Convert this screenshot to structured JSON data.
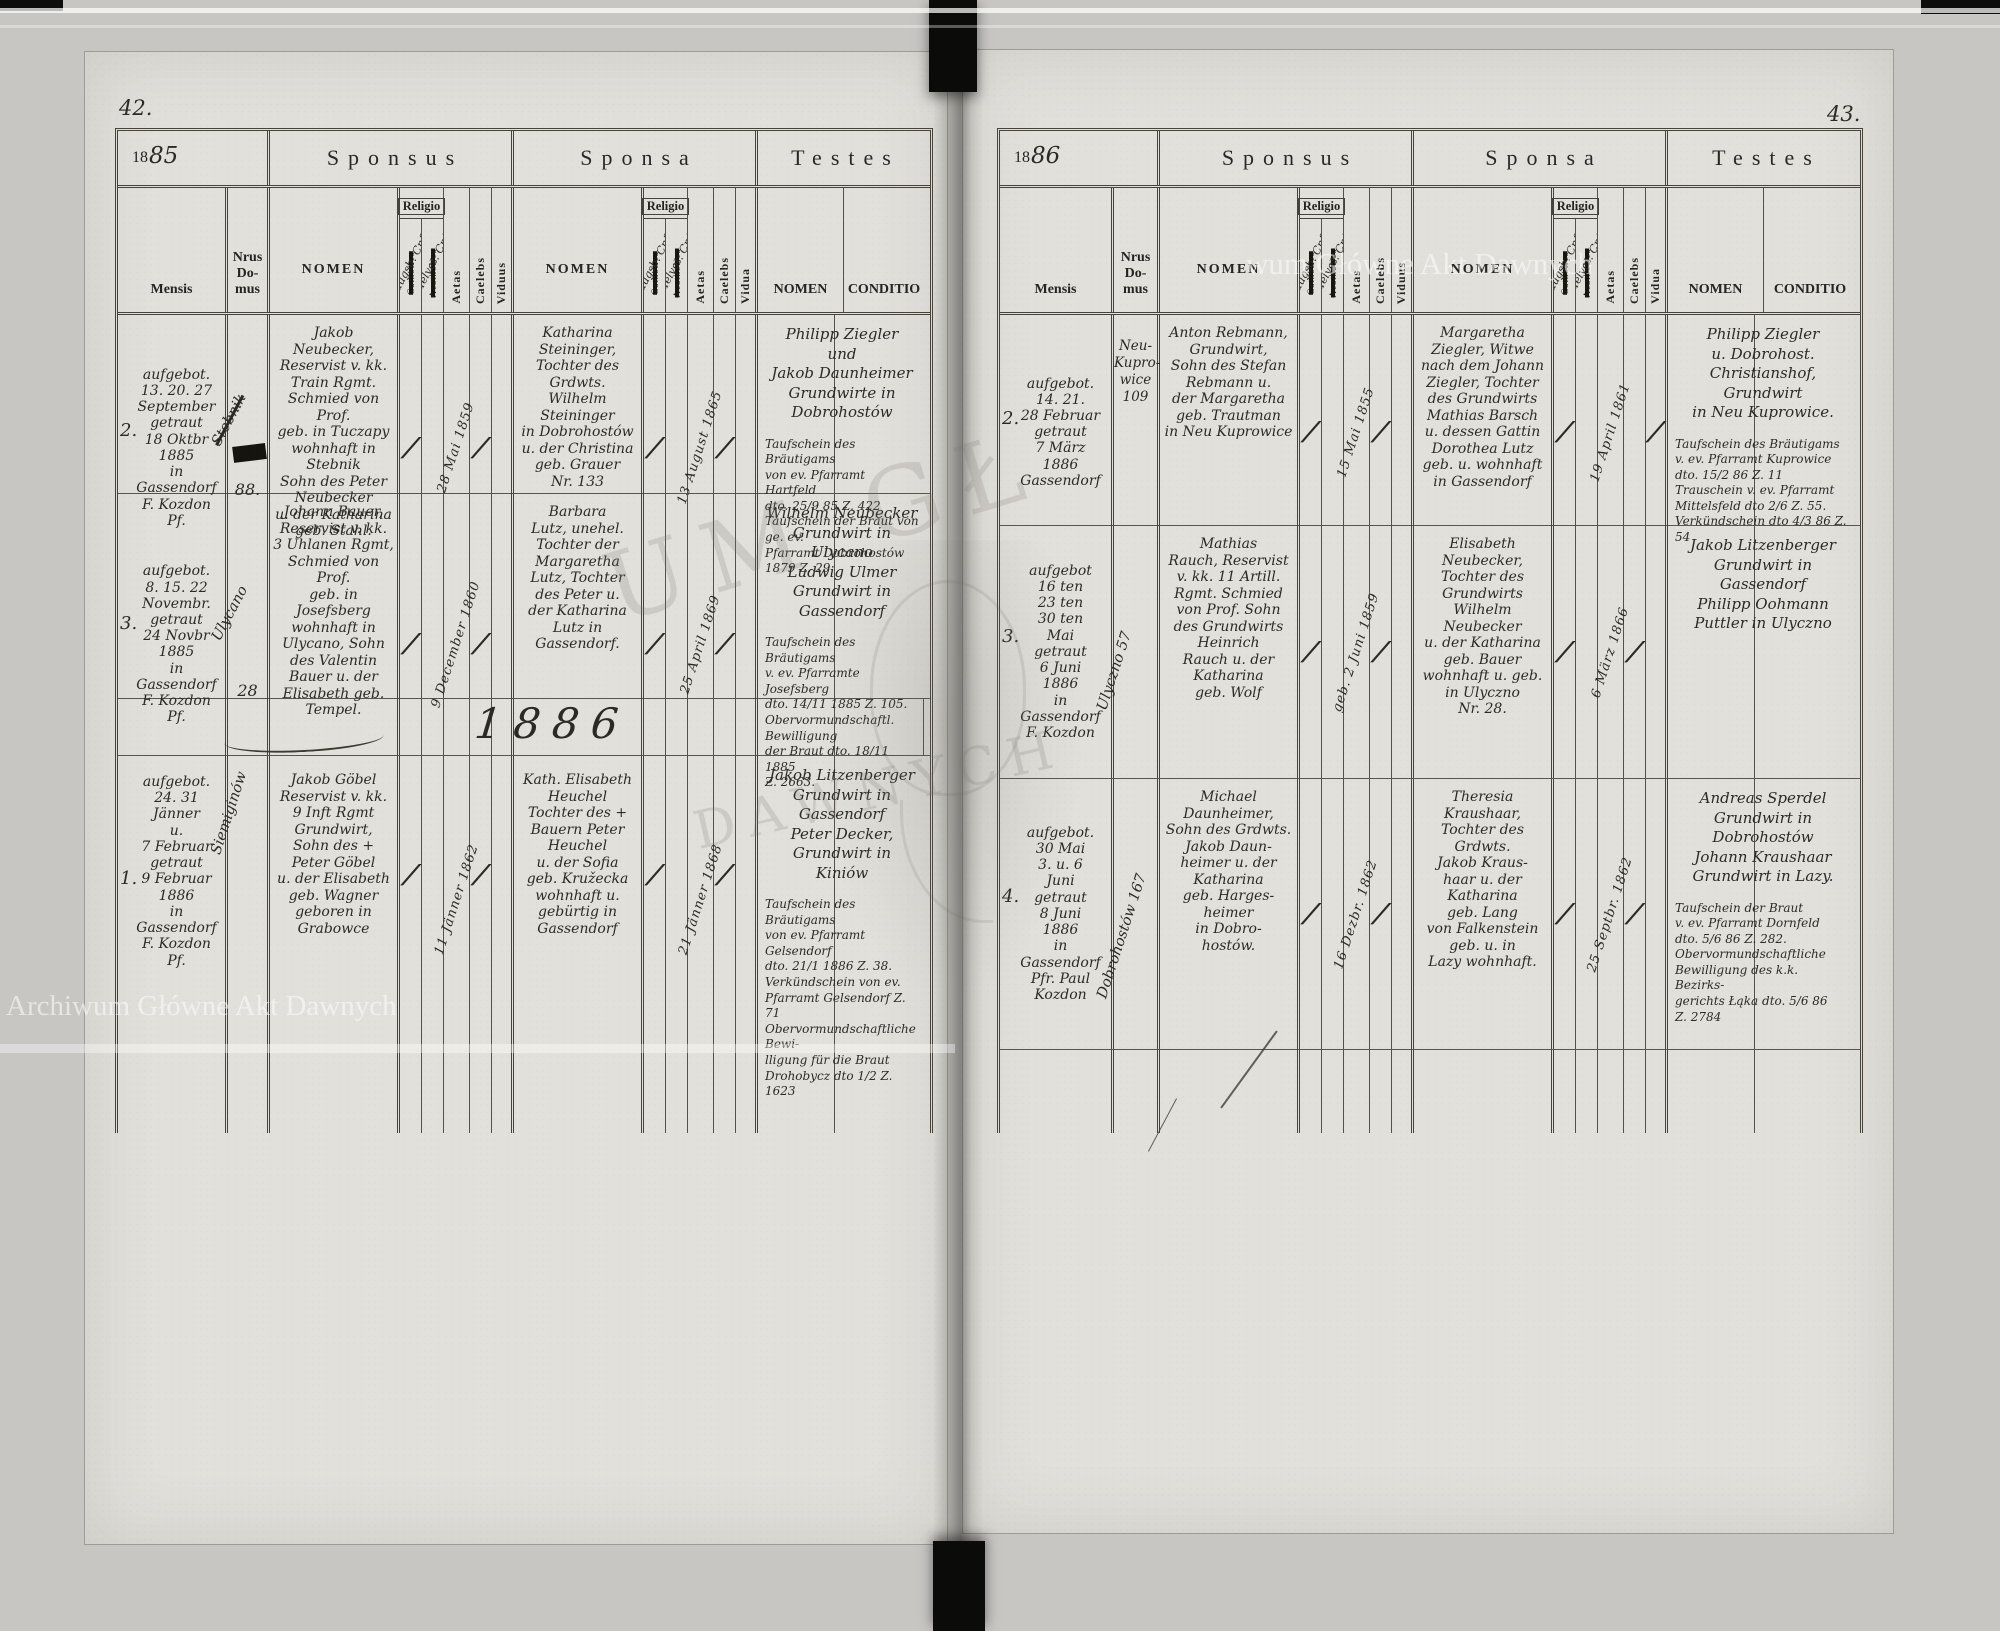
{
  "watermark": {
    "full": "Archiwum Główne Akt Dawnych",
    "top_right_partial": "wum Główne Akt Dawnych",
    "center_fragment_1": "UM GŁ",
    "center_fragment_2": "DAWNYCH"
  },
  "labels": {
    "sponsus": "Sponsus",
    "sponsa": "Sponsa",
    "testes": "Testes",
    "mensis": "Mensis",
    "nrus": "Nrus\nDo-\nmus",
    "nomen": "NOMEN",
    "religio": "Religio",
    "religio_catholica": "Catholica",
    "religio_acatholica": "Acatholica",
    "religio_augsb": "augsb. Cnf.",
    "religio_helv": "Helvet. Cnf.",
    "aetas": "Aetas",
    "caelebs": "Caelebs",
    "viduus": "Viduus",
    "vidua": "Vidua",
    "conditio": "CONDITIO"
  },
  "pages": [
    {
      "page_number": "42.",
      "year_printed": "18",
      "year_hand": "85",
      "year_band": "1886",
      "entries": [
        {
          "no": "2.",
          "mensis": "aufgebot.\n13. 20. 27\nSeptember\ngetraut\n18 Oktbr\n1885\nin\nGassendorf\nF. Kozdon\nPf.",
          "nrus_diag": "Stebnik",
          "nrus_struck": "111",
          "nrus": "88.",
          "sponsus_nomen": "Jakob Neubecker,\nReservist v. kk.\nTrain Rgmt.\nSchmied von Prof.\ngeb. in Tuczapy\nwohnhaft in Stebnik\nSohn des Peter\nNeubecker\nu. der Katharina\ngeb. Stahl.",
          "sp_rel": "/",
          "sp_aetas": "28 Mai 1859",
          "sp_caelebs": "/",
          "sp_viduus": "",
          "sponsa_nomen": "Katharina\nSteininger,\nTochter des Grdwts.\nWilhelm\nSteininger\nin Dobrohostów\nu. der Christina\ngeb. Grauer\nNr. 133",
          "spa_rel": "/",
          "spa_aetas": "13 August 1865",
          "spa_caelebs": "/",
          "spa_vidua": "",
          "testes_nomen": "Philipp Ziegler\nund\nJakob Daunheimer\nGrundwirte in Dobrohostów",
          "testes_notes": "Taufschein des Bräutigams\nvon ev. Pfarramt Hartfeld\ndto. 25/9 85 Z. 422\nTaufschein der Braut von ge. ev.\nPfarramt Dobrohostów 1879 Z. 29"
        },
        {
          "no": "3.",
          "mensis": "aufgebot.\n8. 15. 22\nNovembr.\ngetraut\n24 Novbr\n1885\nin\nGassendorf\nF. Kozdon\nPf.",
          "nrus_diag": "Ulycano",
          "nrus_struck": "",
          "nrus": "28",
          "sponsus_nomen": "Johann Bauer,\nReservist v. kk.\n3 Uhlanen Rgmt,\nSchmied von Prof.\ngeb. in Josefsberg\nwohnhaft in\nUlycano, Sohn\ndes Valentin\nBauer u. der\nElisabeth geb.\nTempel.",
          "sp_rel": "/",
          "sp_aetas": "9 December 1860",
          "sp_caelebs": "/",
          "sp_viduus": "",
          "sponsa_nomen": "Barbara\nLutz, unehel.\nTochter der\nMargaretha\nLutz, Tochter\ndes Peter u.\nder Katharina\nLutz in\nGassendorf.",
          "spa_rel": "/",
          "spa_aetas": "25 April 1869",
          "spa_caelebs": "/",
          "spa_vidua": "",
          "testes_nomen": "Wilhelm Neubecker\nGrundwirt in Ulycano\nLudwig Ulmer\nGrundwirt in Gassendorf",
          "testes_notes": "Taufschein des Bräutigams\nv. ev. Pfarramte Josefsberg\ndto. 14/11 1885 Z. 105.\nObervormundschaftl. Bewilligung\nder Braut dto. 18/11 1885\nZ. 2663."
        },
        {
          "no": "1.",
          "mensis": "aufgebot.\n24. 31\nJänner\nu.\n7 Februar\ngetraut\n9 Februar\n1886\nin\nGassendorf\nF. Kozdon\nPf.",
          "nrus_diag": "Siemiginów",
          "nrus_struck": "",
          "nrus": "",
          "sponsus_nomen": "Jakob Göbel\nReservist v. kk.\n9 Inft Rgmt\nGrundwirt,\nSohn des +\nPeter Göbel\nu. der Elisabeth\ngeb. Wagner\ngeboren in\nGrabowce",
          "sp_rel": "/",
          "sp_aetas": "11 Jänner 1862",
          "sp_caelebs": "/",
          "sp_viduus": "",
          "sponsa_nomen": "Kath. Elisabeth\nHeuchel\nTochter des +\nBauern Peter\nHeuchel\nu. der Sofia\ngeb. Kružecka\nwohnhaft u.\ngebürtig in\nGassendorf",
          "spa_rel": "/",
          "spa_aetas": "21 Jänner 1868",
          "spa_caelebs": "/",
          "spa_vidua": "",
          "testes_nomen": "Jakob Litzenberger\nGrundwirt in\nGassendorf\nPeter Decker,\nGrundwirt in Kiniów",
          "testes_notes": "Taufschein des Bräutigams\nvon ev. Pfarramt Gelsendorf\ndto. 21/1 1886 Z. 38.\nVerkündschein von ev.\nPfarramt Gelsendorf Z. 71\nObervormundschaftliche Bewi-\nlligung für die Braut\nDrohobycz dto 1/2 Z. 1623"
        }
      ]
    },
    {
      "page_number": "43.",
      "year_printed": "18",
      "year_hand": "86",
      "entries": [
        {
          "no": "2.",
          "mensis": "aufgebot.\n14. 21.\n28 Februar\ngetraut\n7 März\n1886\nGassendorf",
          "nrus_diag": "",
          "nrus_struck": "",
          "nrus": "Neu-\nKupro-\nwice\n109",
          "sponsus_nomen": "Anton Rebmann,\nGrundwirt,\nSohn des Stefan\nRebmann u.\nder Margaretha\ngeb. Trautman\nin Neu Kuprowice",
          "sp_rel": "/",
          "sp_aetas": "15 Mai 1855",
          "sp_caelebs": "/",
          "sp_viduus": "",
          "sponsa_nomen": "Margaretha\nZiegler, Witwe\nnach dem Johann\nZiegler, Tochter\ndes Grundwirts\nMathias Barsch\nu. dessen Gattin\nDorothea Lutz\ngeb. u. wohnhaft\nin Gassendorf",
          "spa_rel": "/",
          "spa_aetas": "19 April 1861",
          "spa_caelebs": "",
          "spa_vidua": "/",
          "testes_nomen": "Philipp Ziegler\nu. Dobrohost.\nChristianshof, Grundwirt\nin Neu Kuprowice.",
          "testes_notes": "Taufschein des Bräutigams\nv. ev. Pfarramt Kuprowice\ndto. 15/2 86 Z. 11\nTrauschein v. ev. Pfarramt\nMittelsfeld dto 2/6 Z. 55.\nVerkündschein dto 4/3 86 Z. 54"
        },
        {
          "no": "3.",
          "mensis": "aufgebot\n16 ten\n23 ten\n30 ten\nMai\ngetraut\n6 Juni\n1886\nin\nGassendorf\nF. Kozdon",
          "nrus_diag": "Ulyczno 57",
          "nrus_struck": "",
          "nrus": "",
          "sponsus_nomen": "Mathias\nRauch, Reservist\nv. kk. 11 Artill.\nRgmt. Schmied\nvon Prof. Sohn\ndes Grundwirts\nHeinrich\nRauch u. der\nKatharina\ngeb. Wolf",
          "sp_rel": "/",
          "sp_aetas": "geb. 2 Juni 1859",
          "sp_caelebs": "/",
          "sp_viduus": "",
          "sponsa_nomen": "Elisabeth\nNeubecker,\nTochter des\nGrundwirts\nWilhelm\nNeubecker\nu. der Katharina\ngeb. Bauer\nwohnhaft u. geb.\nin Ulyczno\nNr. 28.",
          "spa_rel": "/",
          "spa_aetas": "6 März 1866",
          "spa_caelebs": "/",
          "spa_vidua": "",
          "testes_nomen": "Jakob Litzenberger\nGrundwirt in\nGassendorf\nPhilipp Oohmann\nPuttler in Ulyczno",
          "testes_notes": ""
        },
        {
          "no": "4.",
          "mensis": "aufgebot.\n30 Mai\n3. u. 6\nJuni\ngetraut\n8 Juni\n1886\nin\nGassendorf\nPfr. Paul\nKozdon",
          "nrus_diag": "Dobrohostów 167",
          "nrus_struck": "",
          "nrus": "",
          "sponsus_nomen": "Michael\nDaunheimer,\nSohn des Grdwts.\nJakob Daun-\nheimer u. der\nKatharina\ngeb. Harges-\nheimer\nin Dobro-\nhostów.",
          "sp_rel": "/",
          "sp_aetas": "16 Dezbr. 1862",
          "sp_caelebs": "/",
          "sp_viduus": "",
          "sponsa_nomen": "Theresia\nKraushaar,\nTochter des Grdwts.\nJakob Kraus-\nhaar u. der\nKatharina\ngeb. Lang\nvon Falkenstein\ngeb. u. in\nLazy wohnhaft.",
          "spa_rel": "/",
          "spa_aetas": "25 Septbr. 1862",
          "spa_caelebs": "/",
          "spa_vidua": "",
          "testes_nomen": "Andreas Sperdel\nGrundwirt in Dobrohostów\nJohann Kraushaar\nGrundwirt in Lazy.",
          "testes_notes": "Taufschein der Braut\nv. ev. Pfarramt Dornfeld\ndto. 5/6 86 Z. 282.\nObervormundschaftliche\nBewilligung des k.k. Bezirks-\ngerichts Łąka dto. 5/6 86\nZ. 2784"
        }
      ]
    }
  ]
}
